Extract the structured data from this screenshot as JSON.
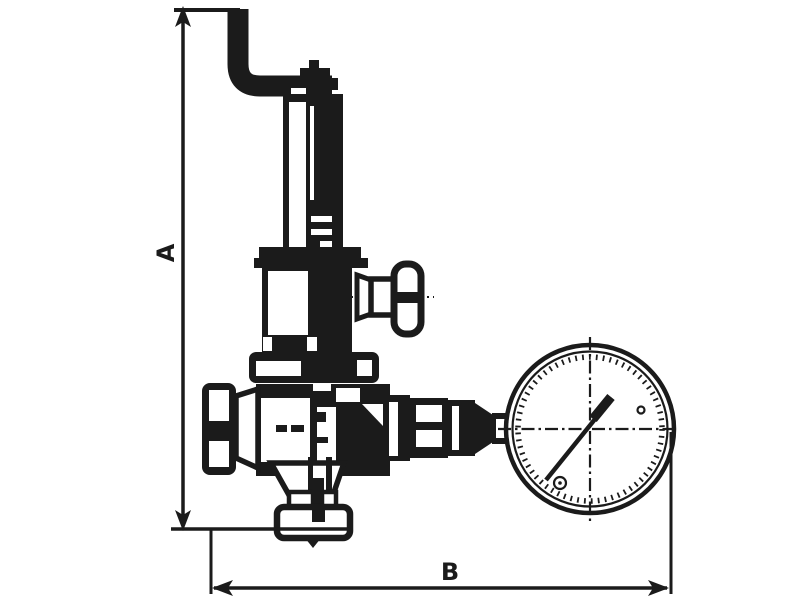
{
  "diagram": {
    "kind": "technical-line-drawing",
    "subject": "spring safety relief valve with side adjustment knobs and pressure gauge (manometer), dimensioned outline drawing",
    "background_color": "#ffffff",
    "line_color": "#1b1b1b",
    "dimension_labels": {
      "vertical": "A",
      "horizontal": "B"
    },
    "components": [
      "vertical-dimension-A",
      "horizontal-dimension-B",
      "relief-discharge-pipe",
      "spring-bonnet",
      "adjusting-cap",
      "side-test-valve-handle",
      "valve-body",
      "inlet-knurled-knob",
      "outlet-union-fittings",
      "pressure-gauge",
      "gauge-needle",
      "bottom-outlet-fitting"
    ]
  }
}
